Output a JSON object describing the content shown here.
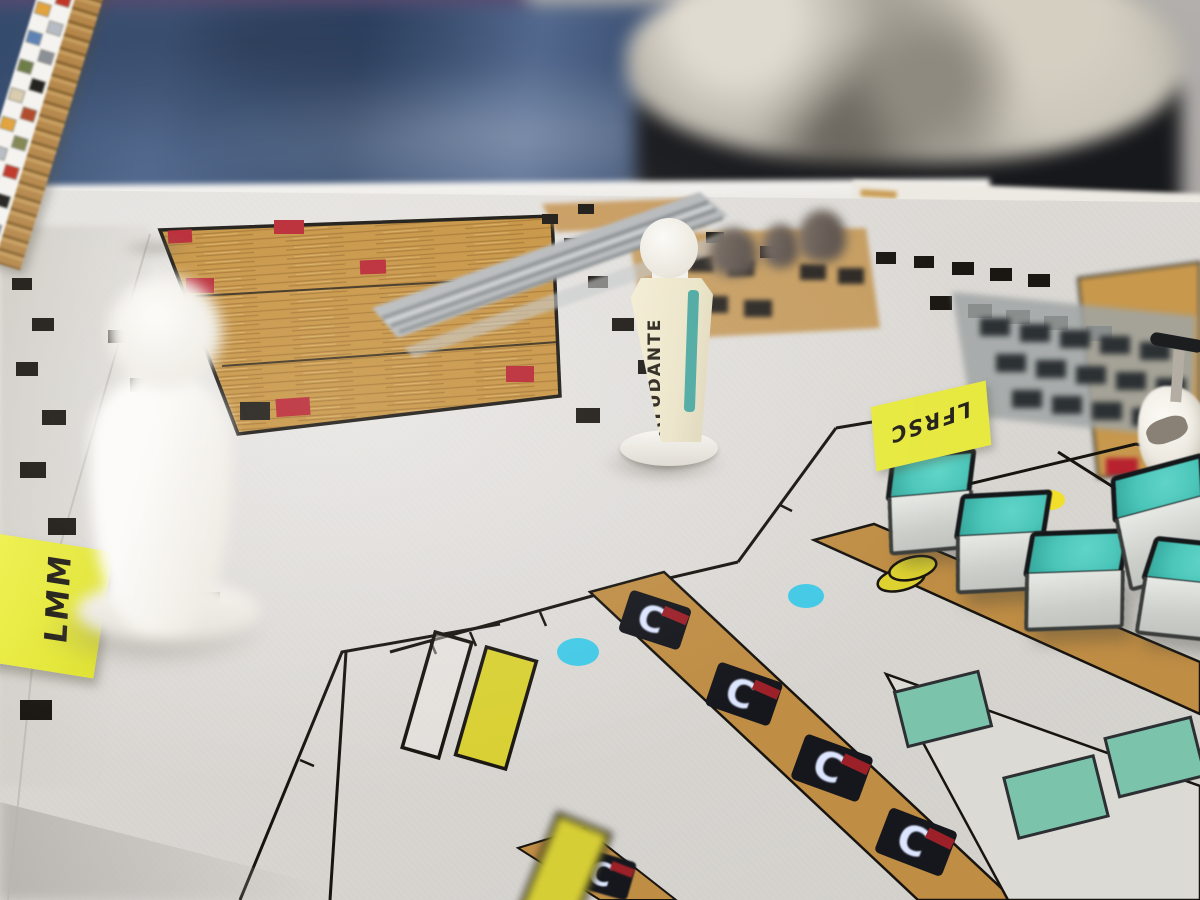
{
  "scene_labels": {
    "figurine_center": "AYUDANTE",
    "sticky_note_left": "LMM",
    "sticky_note_right": "LFRSC",
    "machine_glyph": "C"
  },
  "colors": {
    "map_paper": "#d9d6d2",
    "plan_ink": "#17140f",
    "wood_floor": "#c6923f",
    "corridor_tan": "#bf8d44",
    "red_marker": "#b7222e",
    "teal_table": "#7cc3ac",
    "cube_teal": "#4cc6ba",
    "dot_cyan": "#42c9e6",
    "dot_yellow": "#f2df2b",
    "highlight_yellow": "#d8d032",
    "sticky_yellow": "#e8ea3f",
    "figurine_white": "#f5f3ef",
    "label_stripe_teal": "#4aa8a0",
    "clay_cylinder_brown": "#6e625a",
    "denim_blue": "#3d5575",
    "shirt_tiedye_gray": "#b5b0a8",
    "cardboard_tan": "#c79d5e",
    "rails_gray": "#b0b4b6"
  },
  "legend_strip": {
    "chip_colors": [
      "#818652",
      "#c03527",
      "#e2a23c",
      "#b7bbc3",
      "#5d83b4",
      "#8b8f96",
      "#6f7d49",
      "#23211e",
      "#d9cbae",
      "#b04a2a",
      "#e2a23c",
      "#818652",
      "#b7bbc3",
      "#c03527",
      "#5d83b4",
      "#23211e",
      "#d9cbae",
      "#8b8f96"
    ]
  }
}
